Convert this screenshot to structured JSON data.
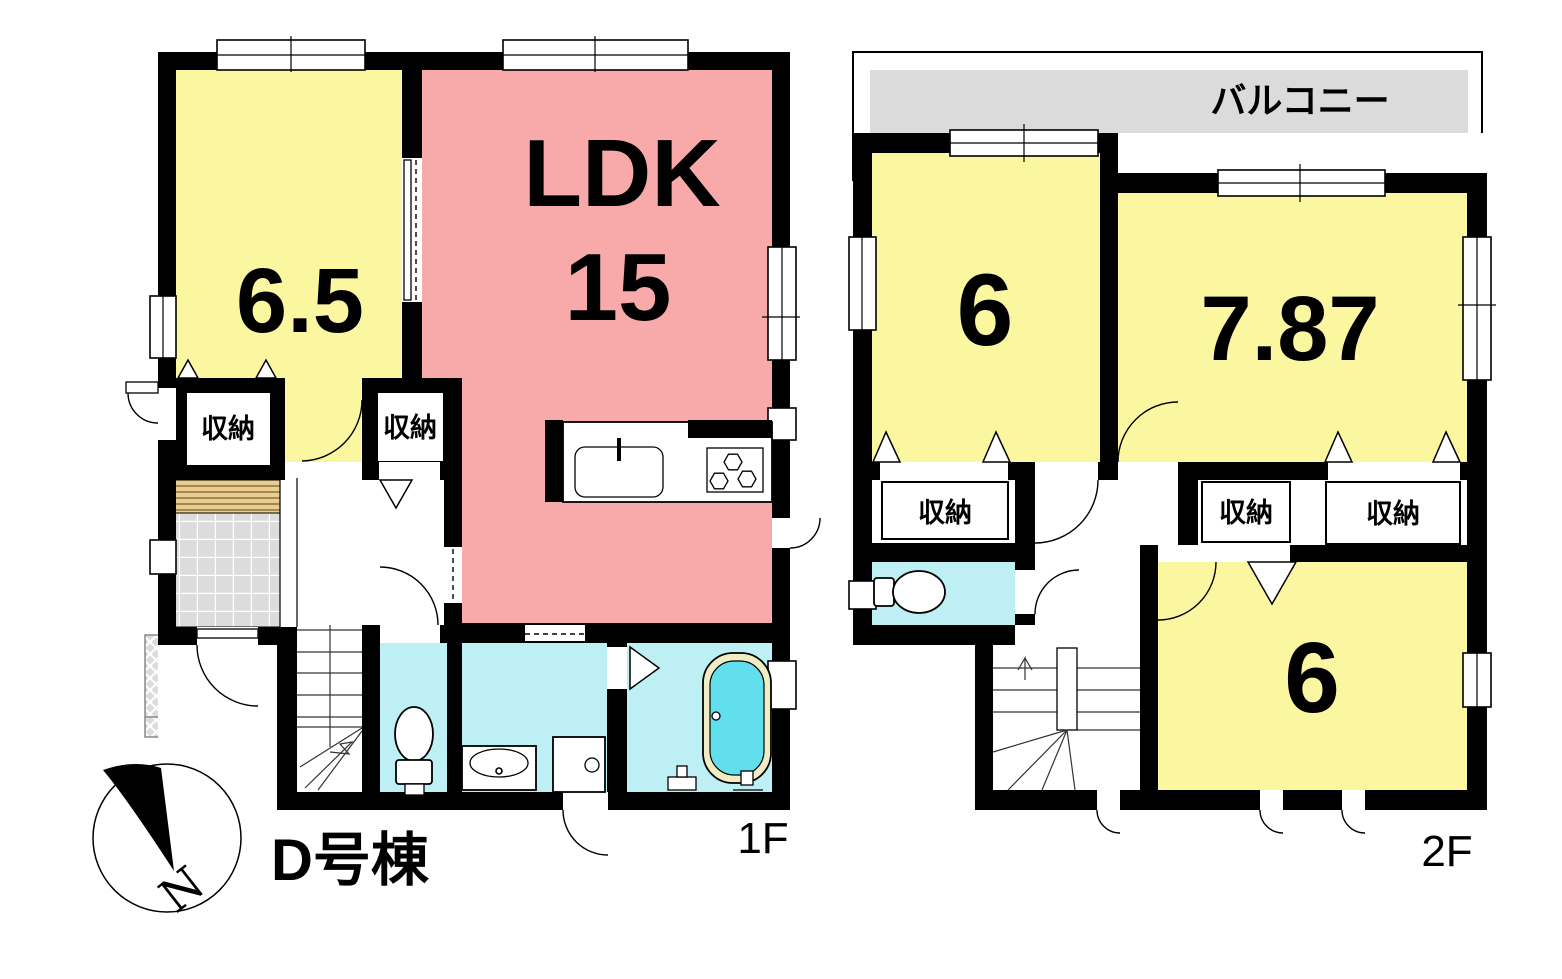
{
  "plan": {
    "building_label": "D号棟",
    "compass_north_label": "N",
    "colors": {
      "wall_black": "#000000",
      "room_yellow": "#FBF7A0",
      "ldk_pink": "#F8A9A9",
      "wet_area_cyan": "#BEEFF4",
      "balcony_gray": "#DBDBDB",
      "entry_tile_gray": "#DCDCDC",
      "tatami_step_tan": "#EACD90",
      "bathtub_water_cyan": "#62DFEC",
      "bathtub_rim_cream": "#F0ECC4"
    },
    "floor1": {
      "floor_label": "1F",
      "bedroom_size": "6.5",
      "ldk_label": "LDK",
      "ldk_size": "15",
      "storage_label_left": "収納",
      "storage_label_hall": "収納"
    },
    "floor2": {
      "floor_label": "2F",
      "balcony_label": "バルコニー",
      "bedroom_left_size": "6",
      "bedroom_right_size": "7.87",
      "bedroom_bottom_size": "6",
      "storage_label_left": "収納",
      "storage_label_middle": "収納",
      "storage_label_right": "収納"
    }
  }
}
